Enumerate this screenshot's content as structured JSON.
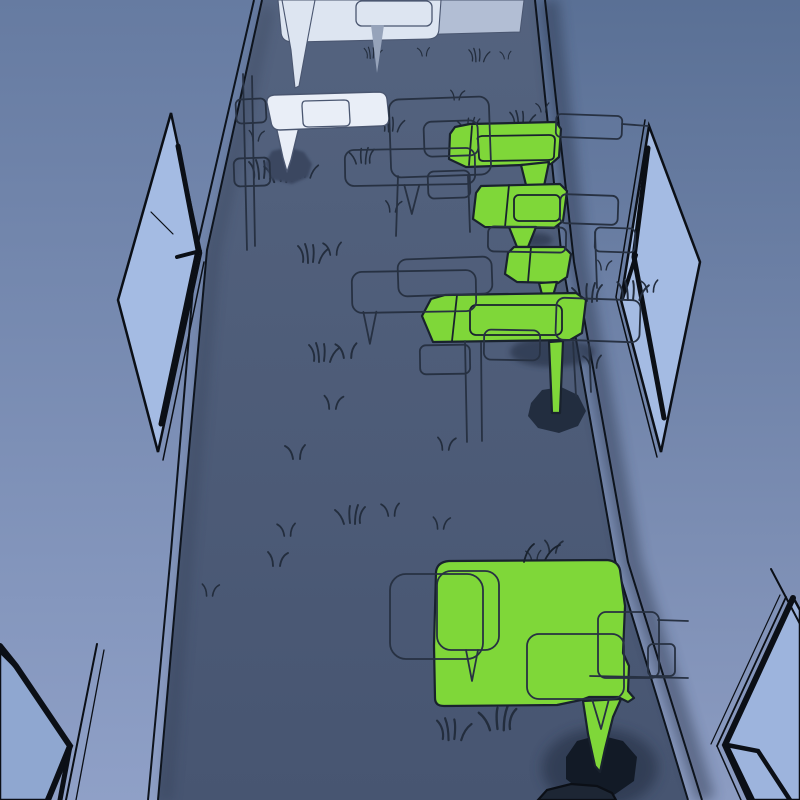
{
  "scene": {
    "kind": "stylized-3d-corridor-with-speech-bubble-signs",
    "colors": {
      "wall-left-top": "#667ba1",
      "wall-left-bottom": "#8fa0c7",
      "wall-right-top": "#5a7095",
      "wall-right-bottom": "#8c9cc2",
      "floor-top": "#54637f",
      "floor-bottom": "#475571",
      "pane": "#a4bbe3",
      "pane-low-left": "#8fa7d0",
      "pane-low-right": "#9db4dd",
      "frame": "#0b0f16",
      "edge-line": "#0e141d",
      "white-bubble": "#e9eef7",
      "white-dim": "#dde5f1",
      "panel": "#b2bed4",
      "gray-tail": "#96a3ba",
      "white-outline": "#4a5670",
      "green": "#7fd739",
      "green-ink": "#19222e",
      "sketch": "#273142",
      "grass": "#232d3d",
      "oct-far": "#3b4761",
      "oct-mid": "#222d3f",
      "oct-near": "#121a26",
      "oct-sliver": "#1d2634",
      "soft-shadow": "#283346"
    },
    "objects": [
      {
        "id": "sign-top-distant",
        "style": "white-bubble"
      },
      {
        "id": "sign-white-mid",
        "style": "white-bubble-on-post",
        "base": "octagon"
      },
      {
        "id": "sign-green-1",
        "style": "green-bubble"
      },
      {
        "id": "sign-green-2",
        "style": "green-bubble"
      },
      {
        "id": "sign-green-3",
        "style": "green-bubble"
      },
      {
        "id": "sign-green-4",
        "style": "green-bubble-on-post",
        "base": "octagon"
      },
      {
        "id": "sign-green-large",
        "style": "green-bubble-with-tail",
        "base": "octagon"
      },
      {
        "id": "windows",
        "count": 4,
        "style": "blue-pane-black-frame"
      }
    ],
    "outline_bubbles": [
      {
        "x": 390,
        "y": 98,
        "w": 100,
        "h": 78,
        "r": 10,
        "rot": -2
      },
      {
        "x": 345,
        "y": 149,
        "w": 130,
        "h": 36,
        "r": 9,
        "rot": -1,
        "tail": [
          404,
          185,
          411,
          214,
          419,
          185
        ]
      },
      {
        "x": 236,
        "y": 99,
        "w": 30,
        "h": 24,
        "r": 5,
        "rot": -3
      },
      {
        "x": 234,
        "y": 158,
        "w": 36,
        "h": 28,
        "r": 6,
        "rot": -2
      },
      {
        "x": 352,
        "y": 271,
        "w": 124,
        "h": 41,
        "r": 10,
        "rot": -1,
        "tail": [
          363,
          311,
          369,
          343,
          376,
          311
        ]
      },
      {
        "x": 398,
        "y": 258,
        "w": 94,
        "h": 37,
        "r": 9,
        "rot": -2
      },
      {
        "x": 424,
        "y": 121,
        "w": 54,
        "h": 35,
        "r": 8,
        "rot": -2
      },
      {
        "x": 556,
        "y": 115,
        "w": 66,
        "h": 23,
        "r": 5,
        "rot": 2
      },
      {
        "x": 560,
        "y": 195,
        "w": 58,
        "h": 29,
        "r": 6,
        "rot": 2
      },
      {
        "x": 488,
        "y": 227,
        "w": 78,
        "h": 25,
        "r": 6,
        "rot": 1
      },
      {
        "x": 556,
        "y": 299,
        "w": 84,
        "h": 42,
        "r": 8,
        "rot": 2
      },
      {
        "x": 420,
        "y": 345,
        "w": 50,
        "h": 29,
        "r": 6,
        "rot": -1
      },
      {
        "x": 428,
        "y": 171,
        "w": 42,
        "h": 27,
        "r": 6,
        "rot": -2
      },
      {
        "x": 484,
        "y": 330,
        "w": 56,
        "h": 30,
        "r": 7,
        "rot": 1
      },
      {
        "x": 595,
        "y": 228,
        "w": 40,
        "h": 24,
        "r": 5,
        "rot": 2
      },
      {
        "x": 390,
        "y": 574,
        "w": 93,
        "h": 85,
        "r": 16,
        "rot": 0
      },
      {
        "x": 437,
        "y": 571,
        "w": 62,
        "h": 79,
        "r": 14,
        "rot": 0,
        "tail": [
          466,
          650,
          472,
          681,
          478,
          650
        ]
      },
      {
        "x": 527,
        "y": 634,
        "w": 97,
        "h": 65,
        "r": 12,
        "rot": 0,
        "tail": [
          592,
          699,
          601,
          729,
          609,
          699
        ]
      },
      {
        "x": 598,
        "y": 612,
        "w": 61,
        "h": 66,
        "r": 8,
        "rot": 0
      },
      {
        "x": 648,
        "y": 644,
        "w": 27,
        "h": 32,
        "r": 5,
        "rot": 0
      }
    ],
    "sketch_lines": [
      [
        243,
        74,
        247,
        250
      ],
      [
        252,
        76,
        255,
        246
      ],
      [
        398,
        176,
        396,
        236
      ],
      [
        468,
        176,
        470,
        232
      ],
      [
        465,
        341,
        467,
        442
      ],
      [
        481,
        343,
        482,
        441
      ],
      [
        573,
        342,
        576,
        396
      ],
      [
        589,
        344,
        591,
        392
      ],
      [
        658,
        620,
        688,
        621
      ],
      [
        590,
        676,
        688,
        678
      ],
      [
        622,
        124,
        648,
        126
      ],
      [
        595,
        232,
        597,
        288
      ]
    ],
    "grass": [
      {
        "x": 262,
        "y": 178,
        "s": 1.0,
        "f": 0,
        "v": 0
      },
      {
        "x": 283,
        "y": 181,
        "s": 1.1,
        "f": 1,
        "v": 0
      },
      {
        "x": 303,
        "y": 177,
        "s": 0.9,
        "f": 0,
        "v": 0
      },
      {
        "x": 256,
        "y": 141,
        "s": 0.75,
        "f": 0,
        "v": 1
      },
      {
        "x": 363,
        "y": 163,
        "s": 0.85,
        "f": 1,
        "v": 0
      },
      {
        "x": 391,
        "y": 131,
        "s": 0.8,
        "f": 0,
        "v": 0
      },
      {
        "x": 372,
        "y": 58,
        "s": 0.6,
        "f": 0,
        "v": 0
      },
      {
        "x": 424,
        "y": 56,
        "s": 0.6,
        "f": 1,
        "v": 1
      },
      {
        "x": 478,
        "y": 61,
        "s": 0.7,
        "f": 0,
        "v": 0
      },
      {
        "x": 506,
        "y": 59,
        "s": 0.55,
        "f": 1,
        "v": 1
      },
      {
        "x": 457,
        "y": 100,
        "s": 0.7,
        "f": 0,
        "v": 1
      },
      {
        "x": 470,
        "y": 131,
        "s": 0.75,
        "f": 1,
        "v": 0
      },
      {
        "x": 521,
        "y": 126,
        "s": 0.85,
        "f": 0,
        "v": 0
      },
      {
        "x": 543,
        "y": 112,
        "s": 0.65,
        "f": 1,
        "v": 1
      },
      {
        "x": 311,
        "y": 262,
        "s": 1.0,
        "f": 0,
        "v": 0
      },
      {
        "x": 333,
        "y": 255,
        "s": 0.9,
        "f": 1,
        "v": 1
      },
      {
        "x": 393,
        "y": 212,
        "s": 0.8,
        "f": 0,
        "v": 1
      },
      {
        "x": 589,
        "y": 301,
        "s": 1.0,
        "f": 1,
        "v": 0
      },
      {
        "x": 631,
        "y": 299,
        "s": 1.05,
        "f": 0,
        "v": 0
      },
      {
        "x": 650,
        "y": 292,
        "s": 0.85,
        "f": 1,
        "v": 1
      },
      {
        "x": 604,
        "y": 270,
        "s": 0.7,
        "f": 0,
        "v": 1
      },
      {
        "x": 593,
        "y": 368,
        "s": 0.9,
        "f": 1,
        "v": 1
      },
      {
        "x": 322,
        "y": 361,
        "s": 1.0,
        "f": 0,
        "v": 0
      },
      {
        "x": 347,
        "y": 358,
        "s": 1.05,
        "f": 1,
        "v": 1
      },
      {
        "x": 333,
        "y": 409,
        "s": 0.95,
        "f": 0,
        "v": 1
      },
      {
        "x": 296,
        "y": 459,
        "s": 1.0,
        "f": 1,
        "v": 1
      },
      {
        "x": 446,
        "y": 450,
        "s": 0.9,
        "f": 0,
        "v": 1
      },
      {
        "x": 391,
        "y": 516,
        "s": 0.9,
        "f": 1,
        "v": 1
      },
      {
        "x": 441,
        "y": 529,
        "s": 0.85,
        "f": 0,
        "v": 1
      },
      {
        "x": 352,
        "y": 523,
        "s": 1.0,
        "f": 1,
        "v": 0
      },
      {
        "x": 277,
        "y": 566,
        "s": 1.0,
        "f": 0,
        "v": 1
      },
      {
        "x": 287,
        "y": 536,
        "s": 0.9,
        "f": 1,
        "v": 1
      },
      {
        "x": 553,
        "y": 553,
        "s": 0.9,
        "f": 0,
        "v": 1
      },
      {
        "x": 534,
        "y": 561,
        "s": 0.75,
        "f": 1,
        "v": 1
      },
      {
        "x": 452,
        "y": 739,
        "s": 1.15,
        "f": 0,
        "v": 0
      },
      {
        "x": 500,
        "y": 729,
        "s": 1.25,
        "f": 1,
        "v": 0
      },
      {
        "x": 210,
        "y": 596,
        "s": 0.85,
        "f": 0,
        "v": 1
      }
    ]
  }
}
